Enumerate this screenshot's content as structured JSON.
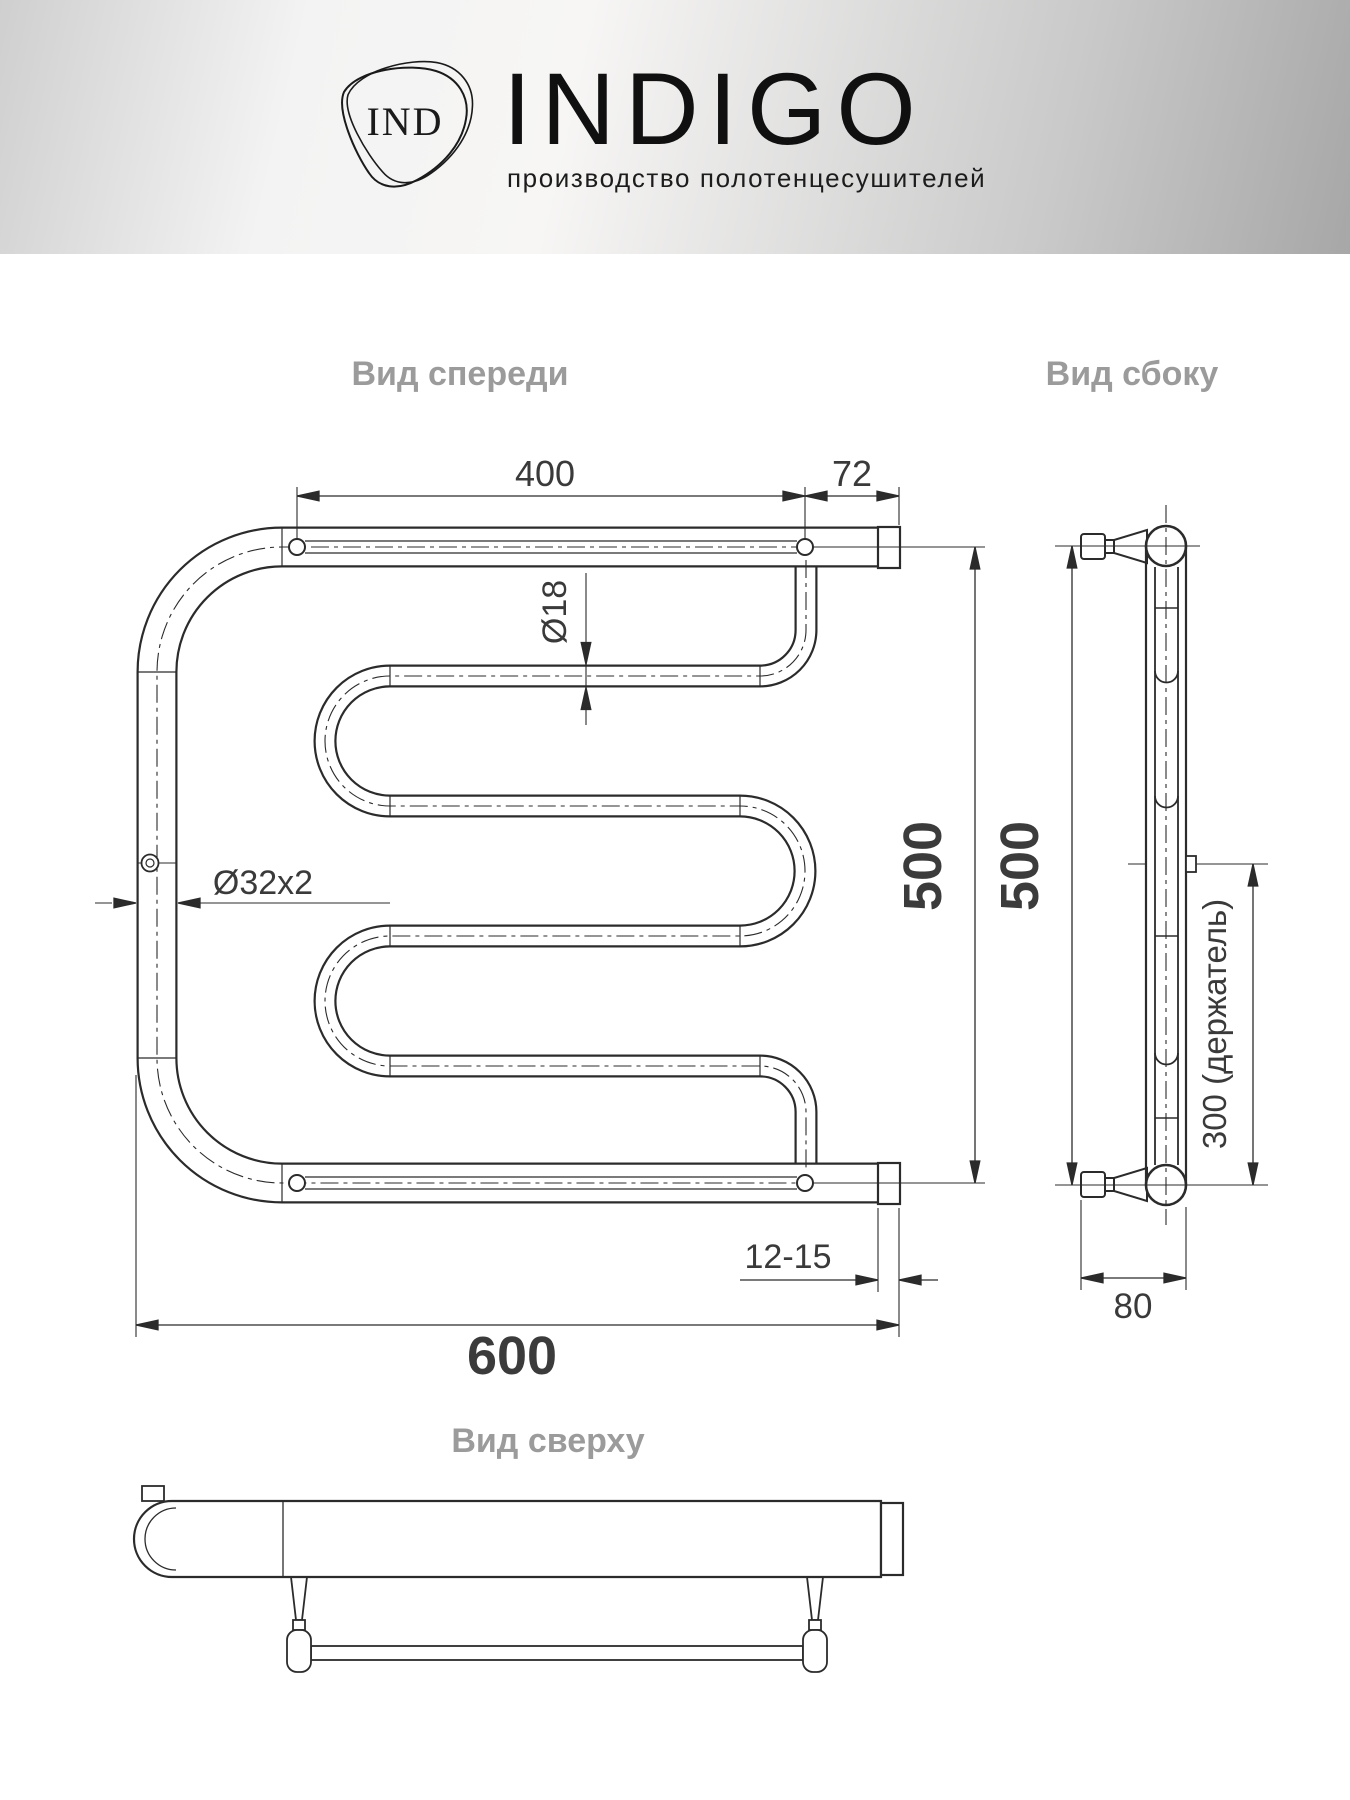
{
  "header": {
    "monogram": "IND",
    "brand": "INDIGO",
    "tagline": "производство полотенцесушителей"
  },
  "front": {
    "label": "Вид спереди",
    "dim_top": "400",
    "dim_offset": "72",
    "dim_tube": "Ø18",
    "dim_pipe": "Ø32x2",
    "dim_height": "500",
    "dim_wall": "12-15",
    "dim_width": "600"
  },
  "side": {
    "label": "Вид сбоку",
    "dim_height": "500",
    "dim_holder": "300 (держатель)",
    "dim_depth": "80"
  },
  "top": {
    "label": "Вид сверху"
  },
  "colors": {
    "line": "#2b2b2b",
    "label_gray": "#9b9b9b",
    "dim_text": "#3a3a3a",
    "header_light": "#f3f3f3",
    "header_dark": "#a7a7a7"
  }
}
